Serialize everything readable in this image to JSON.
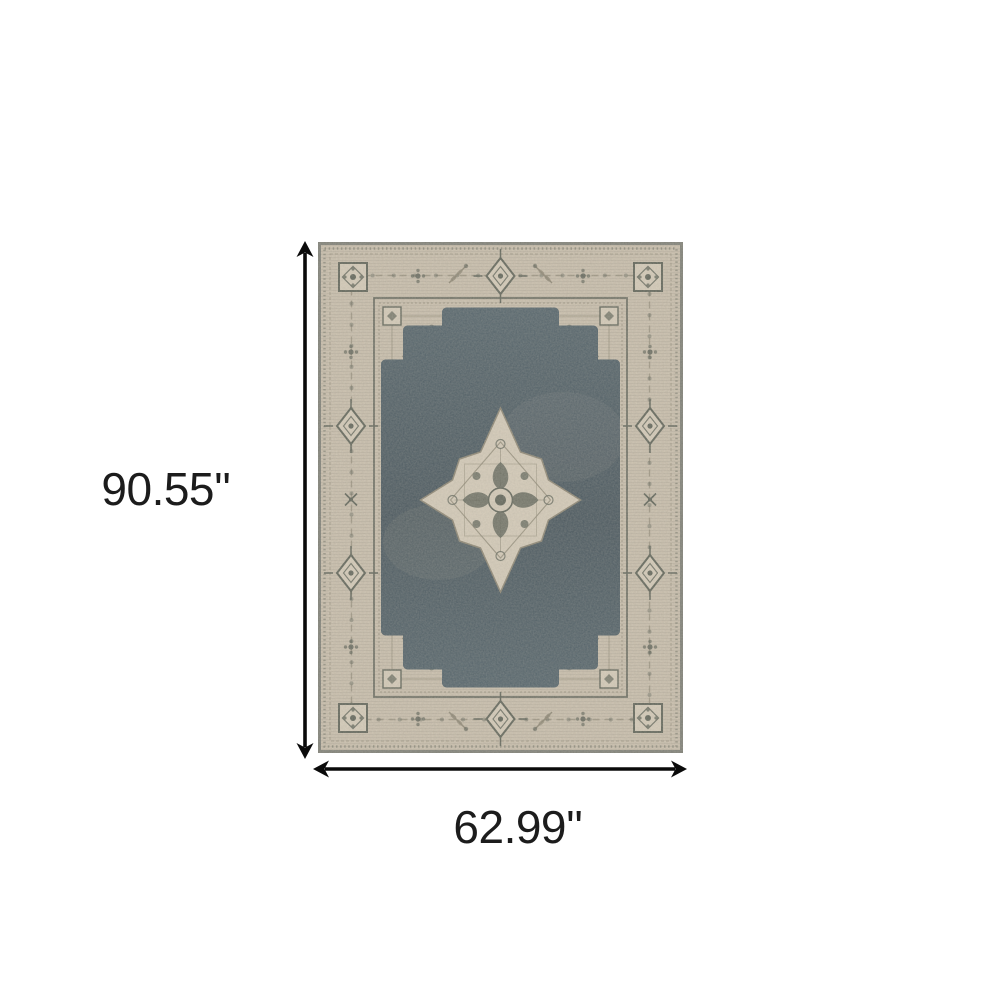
{
  "page": {
    "background": "#ffffff"
  },
  "rug": {
    "style_name": "vintage-medallion-rug",
    "colors": {
      "page_bg": "#ffffff",
      "arrow": "#0a0a0a",
      "label": "#1c1c1c",
      "field": "#506068",
      "field_deep": "#44525a",
      "beige_base": "#c8bdab",
      "beige_light": "#d4cab8",
      "motif_dark": "#5d6156",
      "motif_mid": "#8b8472",
      "edge": "#73766f"
    }
  },
  "annotations": {
    "height_label": "90.55''",
    "width_label": "62.99''"
  }
}
